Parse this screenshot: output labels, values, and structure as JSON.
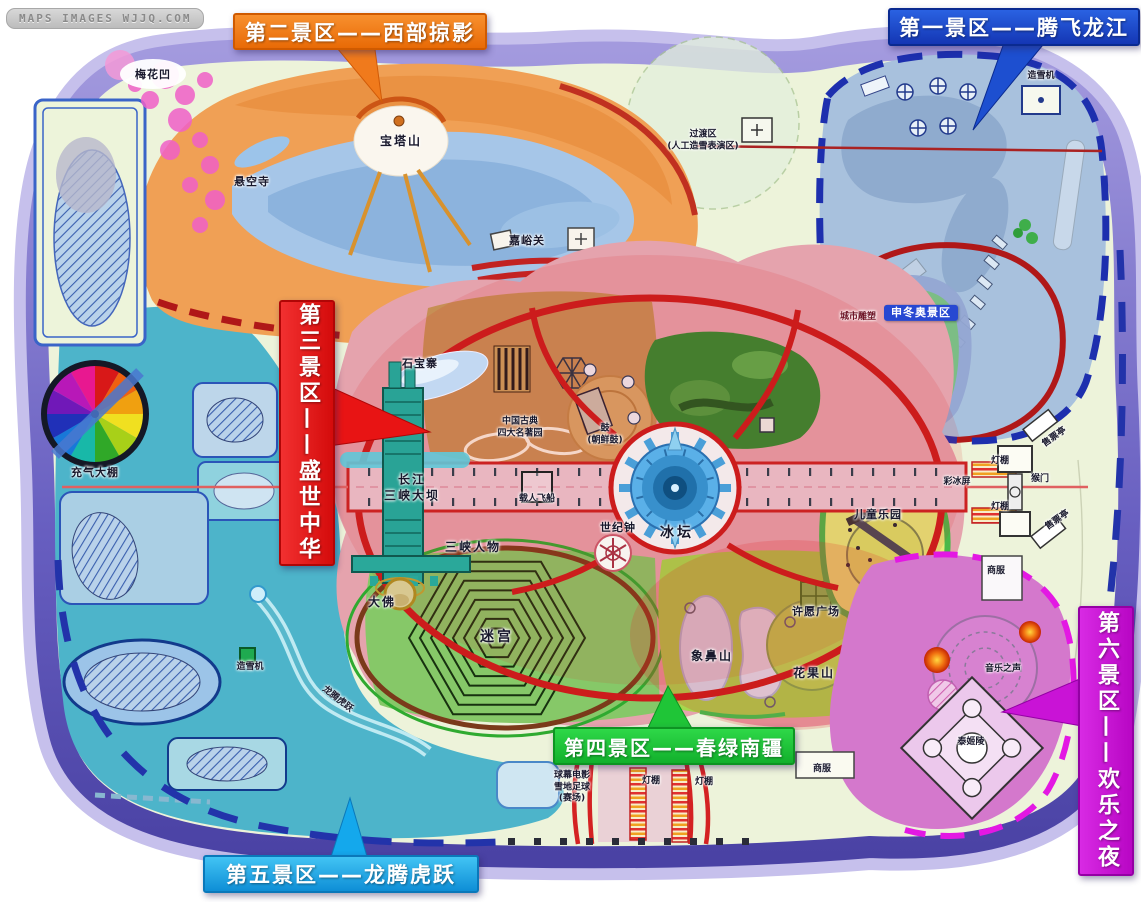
{
  "watermark": "MAPS IMAGES WJJQ.COM",
  "zones": [
    {
      "id": "zone-1",
      "label": "第一景区——腾飞龙江",
      "color": "#1d4fd0"
    },
    {
      "id": "zone-2",
      "label": "第二景区——西部掠影",
      "color": "#f07a1c"
    },
    {
      "id": "zone-3",
      "label": "第三景区——盛世中华",
      "color": "#e81414"
    },
    {
      "id": "zone-4",
      "label": "第四景区——春绿南疆",
      "color": "#1fc537"
    },
    {
      "id": "zone-5",
      "label": "第五景区——龙腾虎跃",
      "color": "#14a8ec"
    },
    {
      "id": "zone-6",
      "label": "第六景区——欢乐之夜",
      "color": "#c913d6"
    }
  ],
  "map": {
    "labels": [
      {
        "text": "梅花凹",
        "x": 153,
        "y": 75
      },
      {
        "text": "悬空寺",
        "x": 252,
        "y": 182
      },
      {
        "text": "宝塔山",
        "x": 401,
        "y": 142,
        "cls": "lbl-md"
      },
      {
        "text": "嘉峪关",
        "x": 527,
        "y": 241
      },
      {
        "text": "过渡区\n(人工造雪表演区)",
        "x": 703,
        "y": 141,
        "cls": "lbl-sm"
      },
      {
        "text": "造雪机",
        "x": 1041,
        "y": 77,
        "cls": "lbl-sm"
      },
      {
        "text": "城市雕塑",
        "x": 858,
        "y": 318,
        "cls": "lbl-sm lbl-maroon"
      },
      {
        "text": "申冬奥景区",
        "x": 921,
        "y": 313,
        "cls": "lbl-badge"
      },
      {
        "text": "石宝寨",
        "x": 420,
        "y": 364
      },
      {
        "text": "中国古典\n四大名著园",
        "x": 520,
        "y": 428,
        "cls": "lbl-sm"
      },
      {
        "text": "鼓\n(朝鲜鼓)",
        "x": 605,
        "y": 435,
        "cls": "lbl-sm"
      },
      {
        "text": "长江\n三峡大坝",
        "x": 412,
        "y": 488,
        "cls": "lbl-md"
      },
      {
        "text": "载人飞船",
        "x": 537,
        "y": 500,
        "cls": "lbl-sm"
      },
      {
        "text": "世纪钟",
        "x": 618,
        "y": 528
      },
      {
        "text": "冰坛",
        "x": 677,
        "y": 533,
        "cls": "lbl-lg"
      },
      {
        "text": "三峡人物",
        "x": 473,
        "y": 548,
        "cls": "lbl-md"
      },
      {
        "text": "大佛",
        "x": 382,
        "y": 603,
        "cls": "lbl-md"
      },
      {
        "text": "迷宫",
        "x": 497,
        "y": 637,
        "cls": "lbl-lg"
      },
      {
        "text": "许愿广场",
        "x": 816,
        "y": 612
      },
      {
        "text": "象鼻山",
        "x": 712,
        "y": 657,
        "cls": "lbl-md"
      },
      {
        "text": "花果山",
        "x": 814,
        "y": 674,
        "cls": "lbl-md"
      },
      {
        "text": "儿童乐园",
        "x": 878,
        "y": 515
      },
      {
        "text": "充气大棚",
        "x": 95,
        "y": 473
      },
      {
        "text": "造雪机",
        "x": 250,
        "y": 668,
        "cls": "lbl-sm"
      },
      {
        "text": "龙腾虎跃",
        "x": 337,
        "y": 700,
        "cls": "lbl-sm rotR"
      },
      {
        "text": "球幕电影\n雪地足球\n(赛场)",
        "x": 572,
        "y": 788,
        "cls": "lbl-sm"
      },
      {
        "text": "灯棚",
        "x": 651,
        "y": 782,
        "cls": "lbl-sm"
      },
      {
        "text": "灯棚",
        "x": 704,
        "y": 783,
        "cls": "lbl-sm"
      },
      {
        "text": "商服",
        "x": 822,
        "y": 770,
        "cls": "lbl-sm"
      },
      {
        "text": "商服",
        "x": 996,
        "y": 572,
        "cls": "lbl-sm"
      },
      {
        "text": "灯棚",
        "x": 1000,
        "y": 462,
        "cls": "lbl-sm"
      },
      {
        "text": "灯棚",
        "x": 1000,
        "y": 508,
        "cls": "lbl-sm"
      },
      {
        "text": "猴门",
        "x": 1040,
        "y": 480,
        "cls": "lbl-sm"
      },
      {
        "text": "彩冰屏",
        "x": 957,
        "y": 483,
        "cls": "lbl-sm"
      },
      {
        "text": "售票亭",
        "x": 1055,
        "y": 438,
        "cls": "lbl-sm rotL"
      },
      {
        "text": "售票亭",
        "x": 1058,
        "y": 521,
        "cls": "lbl-sm rotL"
      },
      {
        "text": "音乐之声",
        "x": 1003,
        "y": 670,
        "cls": "lbl-sm"
      },
      {
        "text": "泰姬陵",
        "x": 971,
        "y": 743,
        "cls": "lbl-sm"
      }
    ]
  }
}
